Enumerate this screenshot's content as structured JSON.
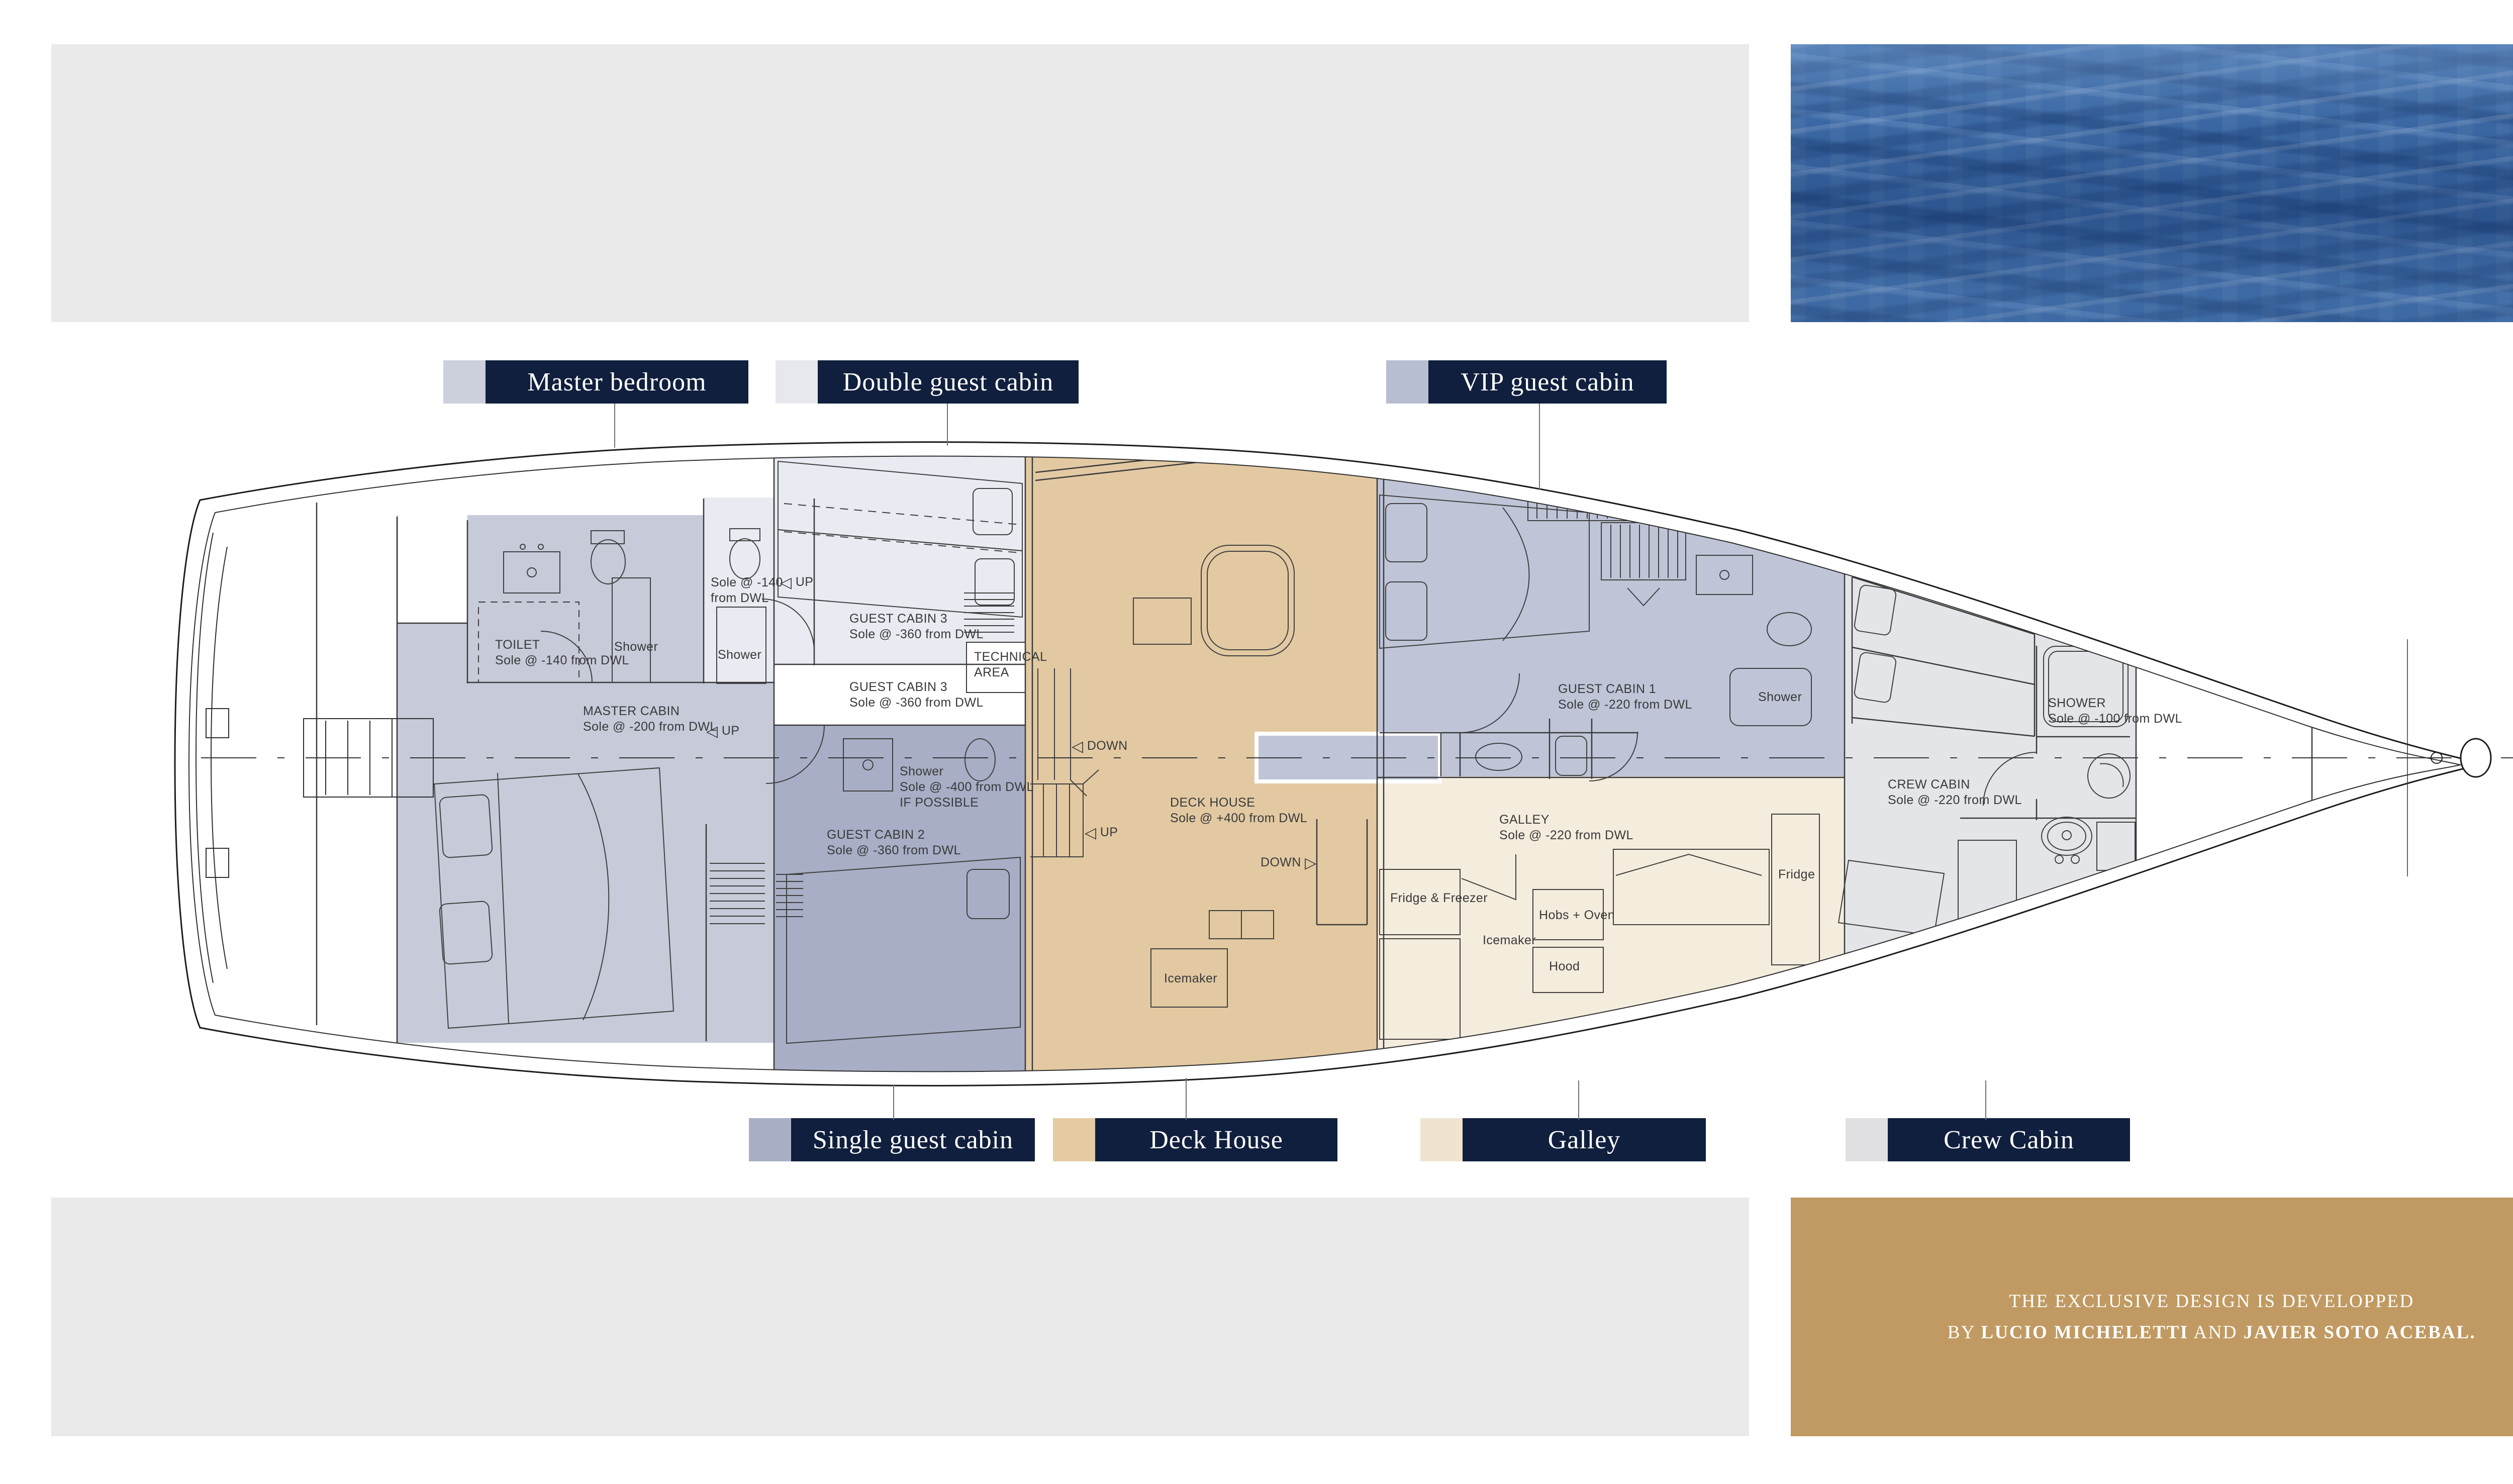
{
  "colors": {
    "navy": "#101f3d",
    "gold": "#c09a62",
    "panel_gray": "#eaeaea",
    "water_blue": "#3e6ca8",
    "master": "#c6cad9",
    "double": "#e9ebf2",
    "vip": "#bfc5d7",
    "single": "#a7aec5",
    "deck_house": "#e2c9a2",
    "galley": "#f4ecdd",
    "crew": "#e4e5e8"
  },
  "legend": {
    "top": [
      {
        "label": "Master bedroom",
        "chip_style": "background:#ccd0dd"
      },
      {
        "label": "Double guest cabin",
        "chip_style": "background:#e6e8ee"
      },
      {
        "label": "VIP guest cabin",
        "chip_style": "background:#b8bed2"
      }
    ],
    "bottom": [
      {
        "label": "Single guest cabin",
        "chip_style": "background:#a8afc5"
      },
      {
        "label": "Deck House",
        "chip_style": "background:#e4cba2"
      },
      {
        "label": "Galley",
        "chip_style": "background:#f0e4d1"
      },
      {
        "label": "Crew Cabin",
        "chip_style": "background:#e0e0e2"
      }
    ]
  },
  "credit": {
    "line1": "THE EXCLUSIVE DESIGN IS DEVELOPPED",
    "by": "BY ",
    "name1": "LUCIO MICHELETTI",
    "and": " AND ",
    "name2": "JAVIER SOTO ACEBAL."
  },
  "plan": {
    "annotations": [
      {
        "lines": [
          "TOILET",
          "Sole @ -140  from DWL"
        ]
      },
      {
        "lines": [
          "Shower"
        ]
      },
      {
        "lines": [
          "Shower"
        ]
      },
      {
        "lines": [
          "Sole @ -140",
          "from DWL"
        ]
      },
      {
        "lines": [
          "MASTER CABIN",
          "Sole @ -200  from DWL"
        ]
      },
      {
        "lines": [
          "GUEST CABIN 3",
          "Sole @ -360  from DWL"
        ]
      },
      {
        "lines": [
          "TECHNICAL",
          "AREA"
        ]
      },
      {
        "lines": [
          "GUEST CABIN 3",
          "Sole @ -360  from DWL"
        ]
      },
      {
        "lines": [
          "Shower",
          "Sole @ -400 from DWL",
          "IF POSSIBLE"
        ]
      },
      {
        "lines": [
          "GUEST CABIN 2",
          "Sole @ -360  from DWL"
        ]
      },
      {
        "lines": [
          "DECK HOUSE",
          "Sole @ +400 from DWL"
        ]
      },
      {
        "lines": [
          "Icemaker"
        ]
      },
      {
        "lines": [
          "GUEST CABIN 1",
          "Sole @ -220 from DWL"
        ]
      },
      {
        "lines": [
          "Shower"
        ]
      },
      {
        "lines": [
          "GALLEY",
          "Sole @ -220 from DWL"
        ]
      },
      {
        "lines": [
          "Fridge & Freezer"
        ]
      },
      {
        "lines": [
          "Hobs + Oven"
        ]
      },
      {
        "lines": [
          "Icemaker"
        ]
      },
      {
        "lines": [
          "Hood"
        ]
      },
      {
        "lines": [
          "Fridge"
        ]
      },
      {
        "lines": [
          "CREW CABIN",
          "Sole @ -220 from DWL"
        ]
      },
      {
        "lines": [
          "SHOWER",
          "Sole @ -100 from DWL"
        ]
      }
    ],
    "arrows": [
      {
        "glyph": "◁",
        "label": "UP"
      },
      {
        "glyph": "◁",
        "label": "UP"
      },
      {
        "glyph": "◁",
        "label": "DOWN"
      },
      {
        "glyph": "◁",
        "label": "UP"
      },
      {
        "glyph": "▷",
        "label": "DOWN"
      }
    ]
  }
}
